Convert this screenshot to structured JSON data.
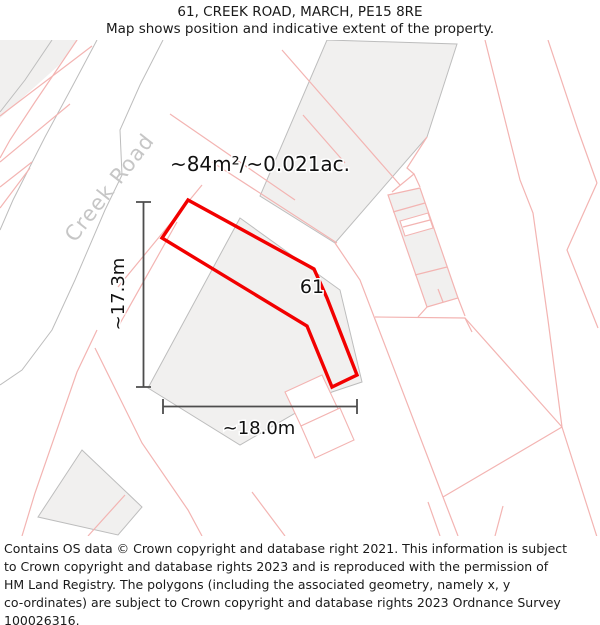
{
  "header": {
    "title": "61, CREEK ROAD, MARCH, PE15 8RE",
    "subtitle": "Map shows position and indicative extent of the property."
  },
  "map": {
    "street_label": "Creek Road",
    "area_label": "~84m²/~0.021ac.",
    "plot_number": "61",
    "dim_vertical_label": "~17.3m",
    "dim_horizontal_label": "~18.0m"
  },
  "footer": {
    "lines": [
      "Contains OS data © Crown copyright and database right 2021. This information is subject",
      "to Crown copyright and database rights 2023 and is reproduced with the permission of",
      "HM Land Registry. The polygons (including the associated geometry, namely x, y",
      "co-ordinates) are subject to Crown copyright and database rights 2023 Ordnance Survey",
      "100026316."
    ]
  },
  "theme": {
    "red": "#f20000",
    "pink": "#f3b4b2",
    "fill": "#f1f0ef",
    "gray": "#bdbdbd",
    "dim": "#4d4d4d",
    "street": "#c6c6c6",
    "ink": "#1a1a1a"
  }
}
